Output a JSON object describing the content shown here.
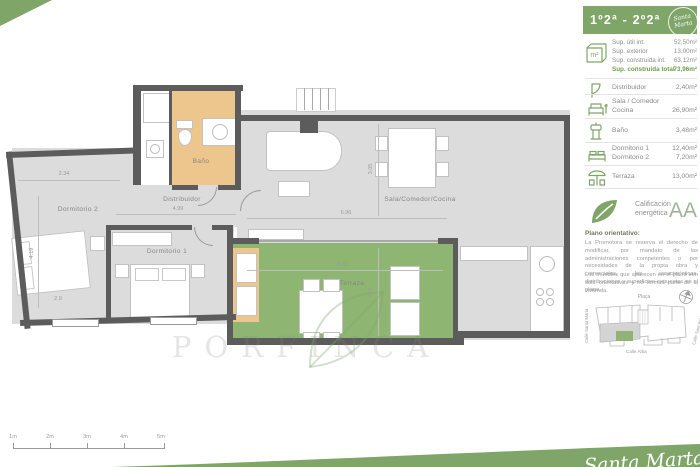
{
  "brand": {
    "green": "#7fa569",
    "wall_gray": "#5c5c5c",
    "floor_gray": "#dcdcdc",
    "bath_orange": "#ecc68c",
    "terrace_green": "#8fb573",
    "value_green": "#6f9e4f"
  },
  "header": {
    "title": "1º2ª - 2º2ª",
    "logo_line1": "Santa",
    "logo_line2": "Marta"
  },
  "surfaces": {
    "icon_label": "m²",
    "rows": [
      {
        "label": "Sup. útil int.",
        "value": "52,50m²"
      },
      {
        "label": "Sup. exterior",
        "value": "13,00m²"
      },
      {
        "label": "Sup. construida int.",
        "value": "63,12m²"
      },
      {
        "label": "Sup. construida total",
        "value": "73,96m²"
      }
    ]
  },
  "rooms": [
    {
      "name": "Distribuidor",
      "value": "2,40m²"
    },
    {
      "name": "Sala / Comedor",
      "name2": "Cocina",
      "value": "26,90m²"
    },
    {
      "name": "Baño",
      "value": "3,48m²"
    },
    {
      "name": "Dormitorio 1",
      "value": "12,40m²",
      "name2": "Dormitorio 2",
      "value2": "7,20m²"
    },
    {
      "name": "Terraza",
      "value": "13,00m²"
    }
  ],
  "energy": {
    "label_line1": "Calificación",
    "label_line2": "energética",
    "rating": "AA"
  },
  "note": {
    "title": "Plano orientativo:",
    "p1": "La Promotora se reserva el derecho de modificar, por mandato de las administraciones competentes o por necesidades de la propia obra y comerciales, las características, distribuciones y superficies expuestas en el plano.",
    "p2": "Los muebles que aparecen en el plano son solo orientativos y no forman parte de la vivienda."
  },
  "map": {
    "street_top": "Plaça",
    "street_left": "Calle Santa Marta",
    "street_right": "Calle Sant Antoni",
    "street_bottom": "Calle Alba"
  },
  "plan": {
    "labels": {
      "dorm2": "Dormitorio 2",
      "dorm1": "Dormitorio 1",
      "distribuidor": "Distribuidor",
      "bano": "Baño",
      "sala": "Sala/Comedor/Cocina",
      "terraza": "Terraza"
    },
    "dims": {
      "d1": "2.34",
      "d2": "4.19",
      "d3": "2.9",
      "d4": "4.99",
      "d5": "6.96",
      "d6": "3.05",
      "d7": "4.70",
      "d8": "2.73"
    }
  },
  "scalebar": {
    "labels": [
      "1m",
      "2m",
      "3m",
      "4m",
      "5m"
    ]
  },
  "watermark": "PORFINCA",
  "signature": "Santa Marta"
}
